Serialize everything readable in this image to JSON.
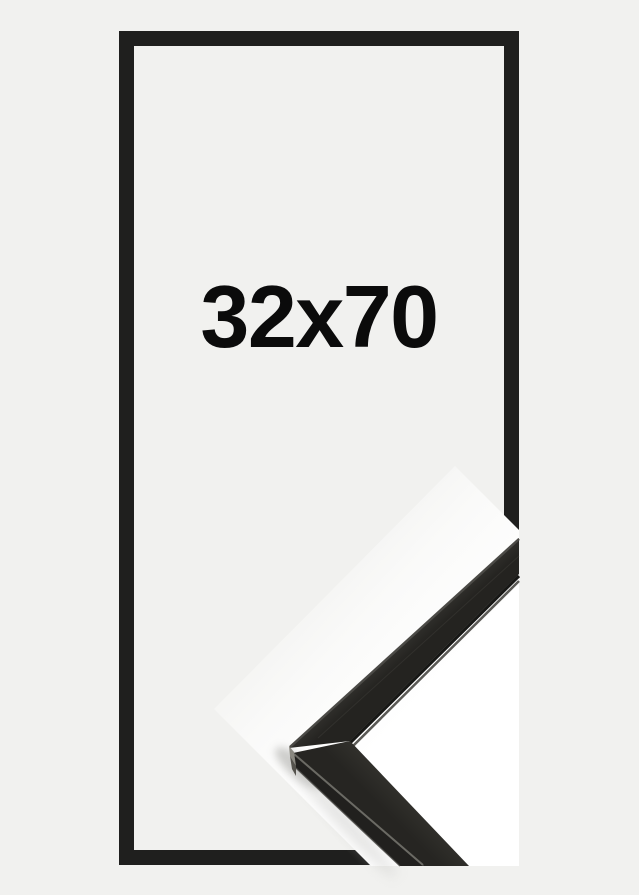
{
  "product": {
    "size_label": "32x70"
  },
  "colors": {
    "bg": "#f1f1ef",
    "frame": "#1f1f1e",
    "label": "#0b0b0b",
    "white": "#ffffff",
    "moulding_top_light": "#403f3b",
    "moulding_top_dark": "#242320",
    "moulding_lower_light": "#35342f",
    "moulding_lower_dark": "#262522",
    "moulding_side": "#21201e",
    "arris": "#6b6a64",
    "bevel": "#4b4a46",
    "lip_dark": "#171715",
    "lip_light": "#5a5955",
    "facet_light": "#8a8880",
    "facet_dark": "#54524c",
    "grain": "#3c3b37",
    "shadow": "#c2c2c0"
  }
}
